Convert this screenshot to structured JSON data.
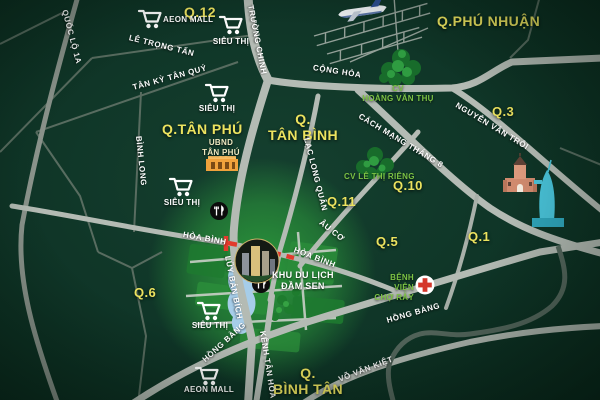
{
  "colors": {
    "background": "#0f3527",
    "district_label": "#ece35f",
    "road_label": "#ffffff",
    "park_label": "#7cc244",
    "road_main": "#b4bbb4",
    "road_minor": "#5c6f63",
    "highlight_route_red": "#e23a2c",
    "glow_green": "#2d9e3c",
    "lake_blue": "#a6cde9",
    "landmark_teal": "#49c3d9",
    "townhall_orange": "#f0a23c",
    "hospital_red": "#d4372b"
  },
  "districts": [
    "Q.12",
    "Q.PHÚ NHUẬN",
    "Q.3",
    "Q.TÂN PHÚ",
    "Q.\nTÂN BÌNH",
    "Q.10",
    "Q.11",
    "Q.5",
    "Q.1",
    "Q.6",
    "Q.\nBÌNH TÂN"
  ],
  "roads": [
    "QUỐC LỘ 1A",
    "TRƯỜNG CHINH",
    "LÊ TRỌNG TẤN",
    "TÂN KỲ TÂN QUÝ",
    "BÌNH LONG",
    "CỘNG HÒA",
    "NGUYỄN VĂN TRỖI",
    "CÁCH MẠNG THÁNG 8",
    "LẠC LONG QUÂN",
    "ÂU CƠ",
    "HÒA BÌNH",
    "HÒA BÌNH",
    "LŨY BÁN BÍCH",
    "KÊNH TÂN HÓA",
    "HỒNG BÀNG",
    "HỒNG BÀNG",
    "VÕ VĂN KIỆT"
  ],
  "shops": [
    {
      "label": "AEON MALL"
    },
    {
      "label": "SIÊU THỊ"
    },
    {
      "label": "SIÊU THỊ"
    },
    {
      "label": "SIÊU THỊ"
    },
    {
      "label": "SIÊU THỊ"
    },
    {
      "label": "AEON MALL"
    }
  ],
  "places": {
    "town_hall": "UBND\nTÂN PHÚ",
    "park_hoang_van_thu": "CV\nHOÀNG VĂN THỤ",
    "park_le_thi_rieng": "CV LÊ THỊ RIÊNG",
    "hospital": "BỆNH VIỆN\nCHỢ RẪY",
    "dam_sen": "KHU DU LỊCH\nĐẦM SEN"
  }
}
